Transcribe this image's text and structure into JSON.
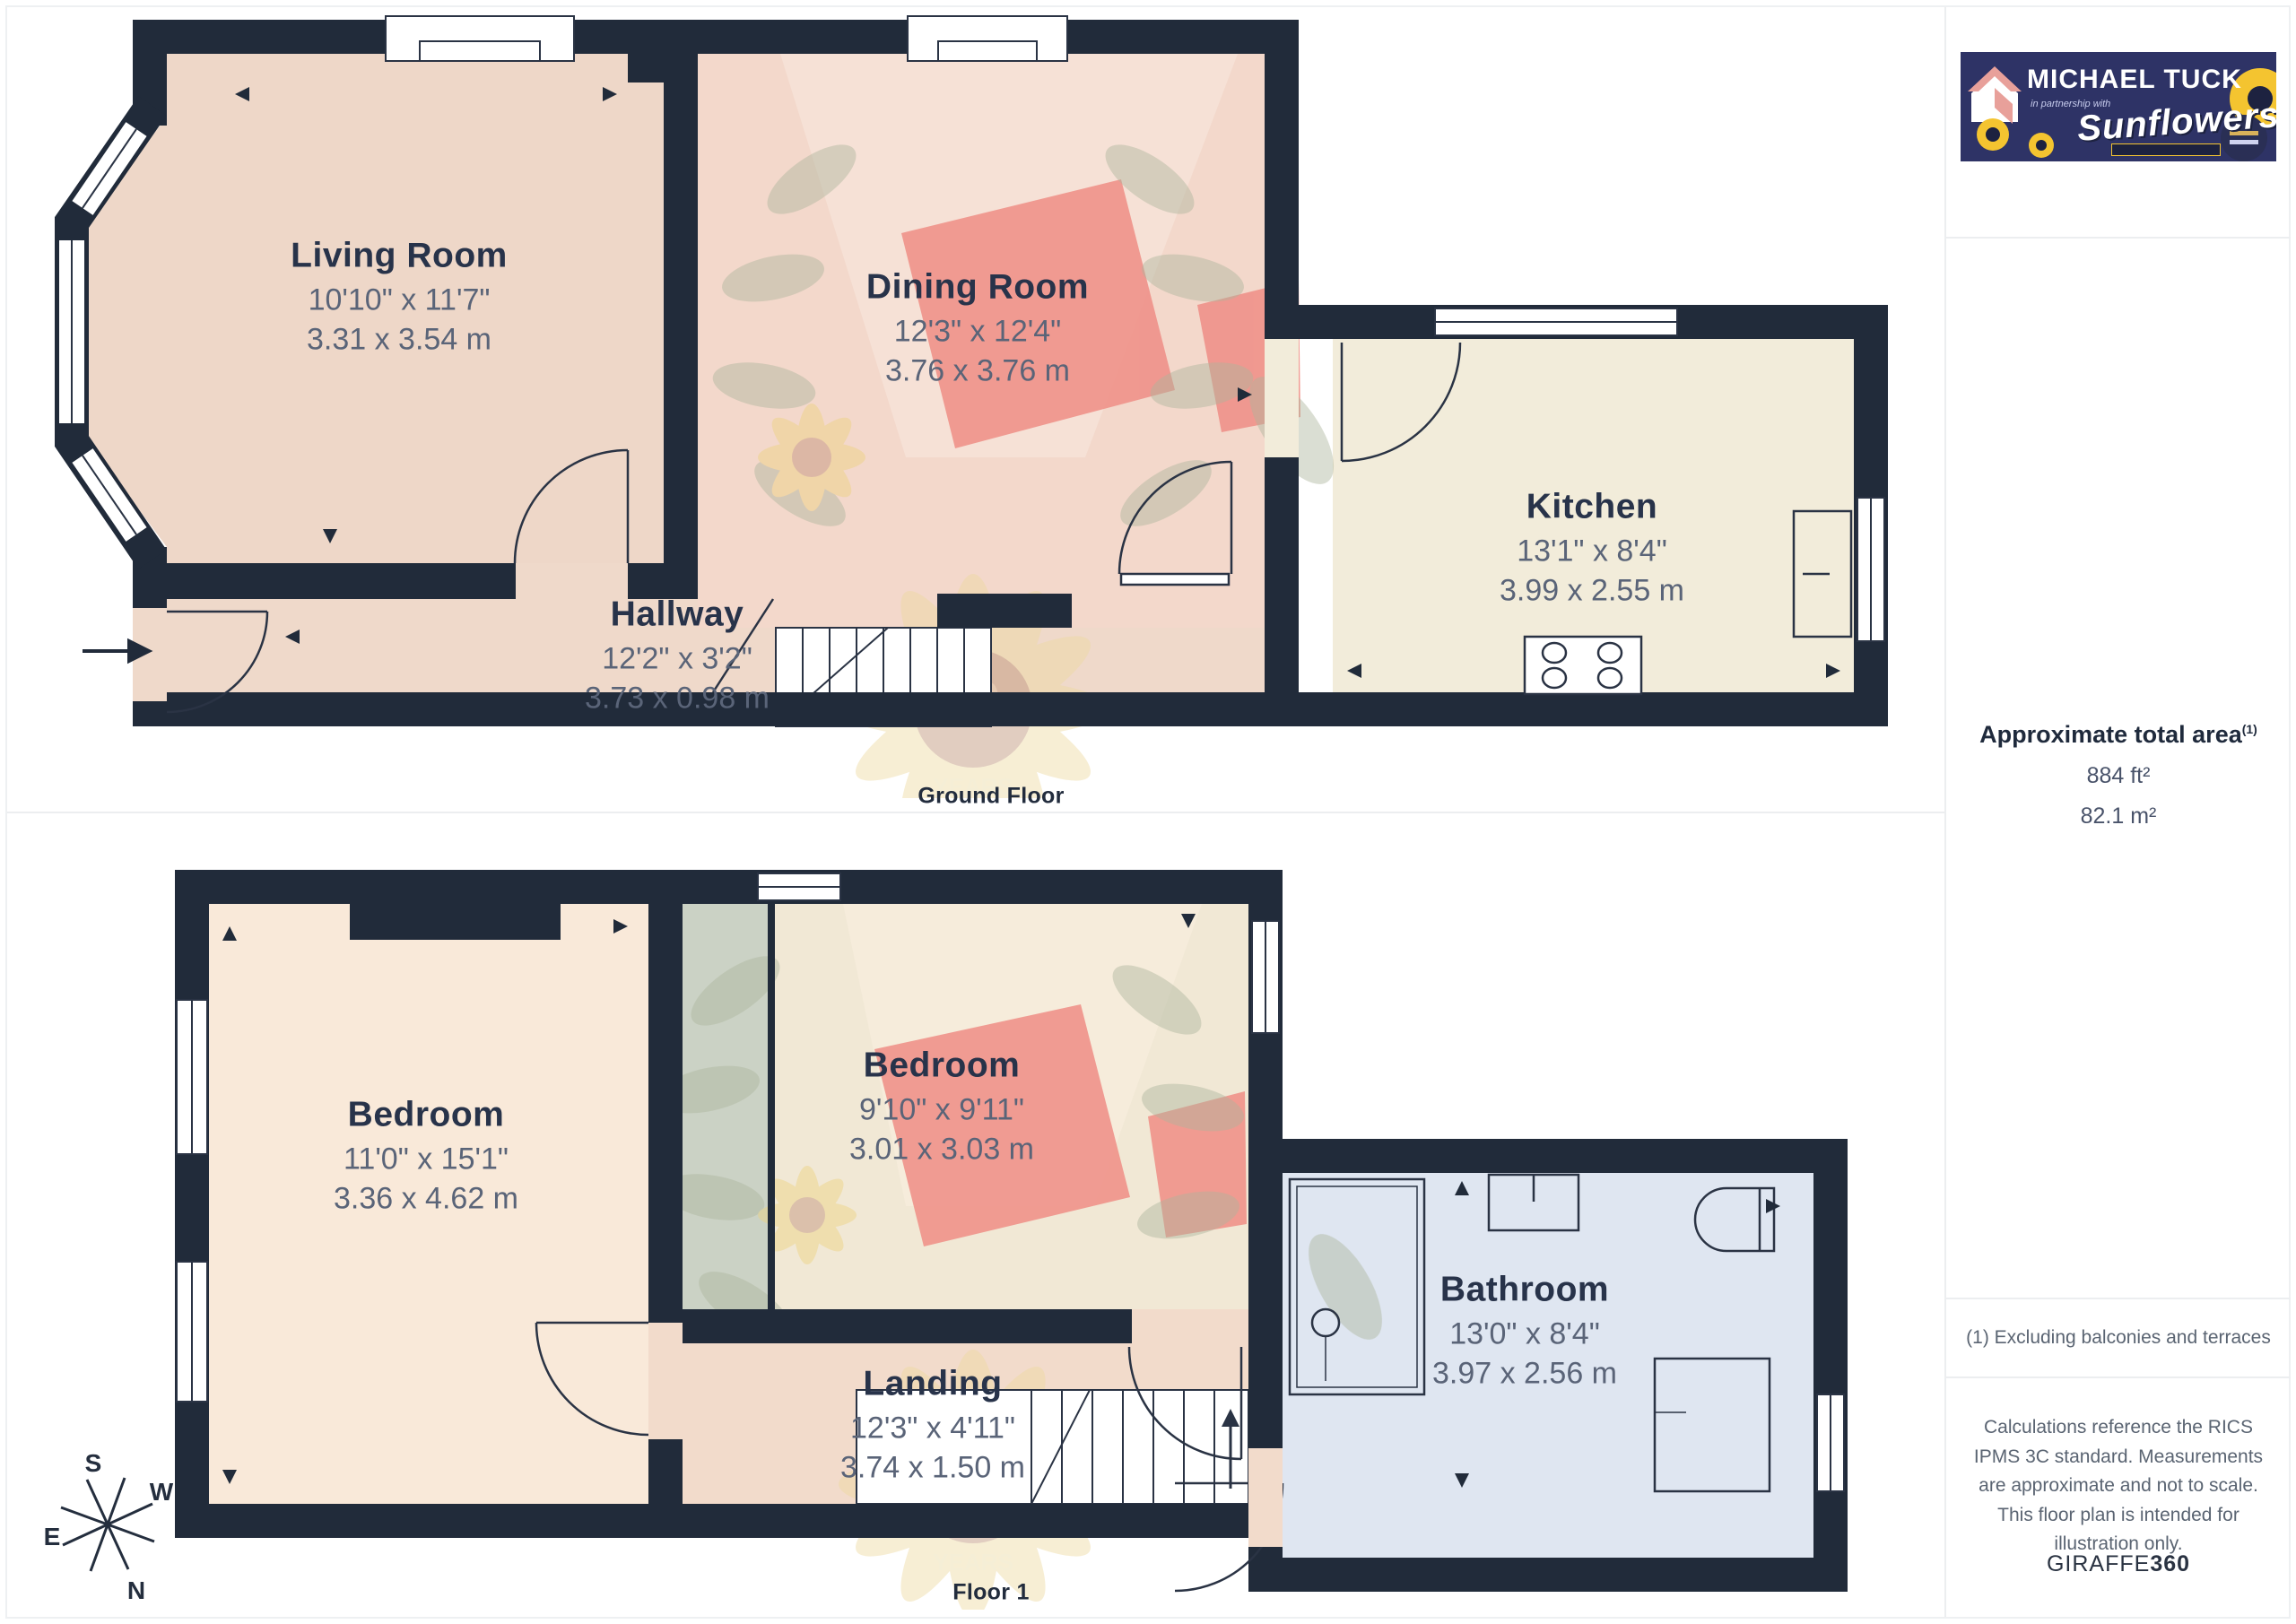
{
  "ground_floor": {
    "caption": "Ground Floor",
    "rooms": [
      {
        "name": "Living Room",
        "imperial": "10'10\" x 11'7\"",
        "metric": "3.31 x 3.54 m"
      },
      {
        "name": "Dining Room",
        "imperial": "12'3\" x 12'4\"",
        "metric": "3.76 x 3.76 m"
      },
      {
        "name": "Kitchen",
        "imperial": "13'1\" x 8'4\"",
        "metric": "3.99 x 2.55 m"
      },
      {
        "name": "Hallway",
        "imperial": "12'2\" x 3'2\"",
        "metric": "3.73 x 0.98 m"
      }
    ]
  },
  "floor_1": {
    "caption": "Floor 1",
    "rooms": [
      {
        "name": "Bedroom",
        "imperial": "11'0\" x 15'1\"",
        "metric": "3.36 x 4.62 m"
      },
      {
        "name": "Bedroom",
        "imperial": "9'10\" x 9'11\"",
        "metric": "3.01 x 3.03 m"
      },
      {
        "name": "Landing",
        "imperial": "12'3\" x 4'11\"",
        "metric": "3.74 x 1.50 m"
      },
      {
        "name": "Bathroom",
        "imperial": "13'0\" x 8'4\"",
        "metric": "3.97 x 2.56 m"
      }
    ]
  },
  "compass": {
    "n": "N",
    "s": "S",
    "e": "E",
    "w": "W"
  },
  "watermark": {
    "line1": "40",
    "line2": "YEARS"
  },
  "sidebar": {
    "logo": {
      "brand": "MICHAEL TUCK",
      "partnership": "in partnership with",
      "script": "Sunflowers"
    },
    "area": {
      "title": "Approximate total area",
      "title_sup": "(1)",
      "imperial": "884 ft²",
      "metric": "82.1 m²"
    },
    "footnote": "(1) Excluding balconies and terraces",
    "disclaimer": "Calculations reference the RICS IPMS 3C standard. Measurements are approximate and not to scale. This floor plan is intended for illustration only.",
    "credit_normal": "GIRAFFE",
    "credit_bold": "360"
  },
  "colors": {
    "wall": "#212b3a",
    "living_floor": "#eed7c8",
    "dining_floor": "#f3d8cb",
    "kitchen_floor": "#f2ecda",
    "hall_floor": "#efd9ca",
    "bedroom1_floor": "#f9e9d9",
    "bedroom2_floor": "#f1e8d5",
    "landing_floor": "#f2dbcb",
    "bathroom_floor": "#dfe6f1",
    "closet_grey": "#cbd2c5",
    "furniture_salmon": "#ef928a",
    "logo_navy": "#2e3366",
    "sunflower_yellow": "#f4c430"
  }
}
